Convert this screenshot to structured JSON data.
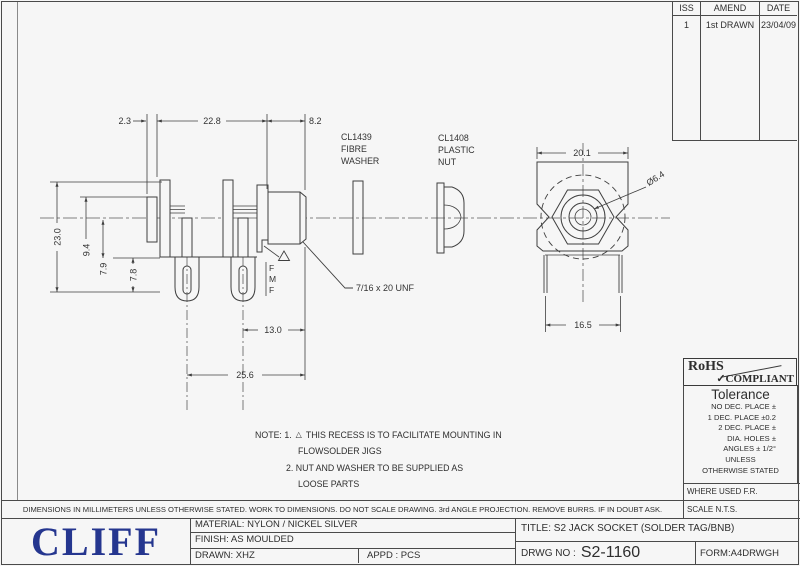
{
  "revision_table": {
    "headers": [
      "ISS",
      "AMEND",
      "DATE"
    ],
    "row": {
      "iss": "1",
      "amend": "1st DRAWN",
      "date": "23/04/09"
    }
  },
  "drawing": {
    "dim_top_left": "2.3",
    "dim_top_mid": "22.8",
    "dim_top_right": "8.2",
    "dim_height": "23.0",
    "dim_left_a": "9.4",
    "dim_left_b": "7.9",
    "dim_left_c": "7.8",
    "dim_bot_a": "13.0",
    "dim_bot_b": "25.6",
    "dim_face_width": "20.1",
    "dim_hole": "Ø6.4",
    "dim_leg_span": "16.5",
    "thread_label": "7/16 x 20 UNF",
    "washer_label": {
      "l1": "CL1439",
      "l2": "FIBRE",
      "l3": "WASHER"
    },
    "nut_label": {
      "l1": "CL1408",
      "l2": "PLASTIC",
      "l3": "NUT"
    },
    "markings": {
      "m1": "F",
      "m2": "M",
      "m3": "F"
    }
  },
  "notes": {
    "label": "NOTE:  1.",
    "triangle": "△",
    "n1a": "THIS RECESS IS TO FACILITATE MOUNTING IN",
    "n1b": "FLOWSOLDER JIGS",
    "n2a": "2. NUT AND WASHER TO BE SUPPLIED AS",
    "n2b": "LOOSE PARTS"
  },
  "rohs": {
    "l1": "RoHS",
    "l2": "✓COMPLIANT"
  },
  "tolerance": {
    "heading": "Tolerance",
    "lines": [
      "NO DEC. PLACE ±",
      "1 DEC. PLACE ±0.2",
      "2 DEC. PLACE ±",
      "DIA. HOLES ±",
      "ANGLES ± 1/2°",
      "UNLESS",
      "OTHERWISE STATED"
    ]
  },
  "footer": {
    "disclaimer": "DIMENSIONS IN MILLIMETERS UNLESS OTHERWISE STATED. WORK TO DIMENSIONS. DO NOT SCALE DRAWING. 3rd ANGLE PROJECTION. REMOVE BURRS. IF IN DOUBT ASK.",
    "where_used": "WHERE USED F.R.",
    "scale": "SCALE N.T.S."
  },
  "title_block": {
    "logo": "CLIFF",
    "material": "MATERIAL: NYLON / NICKEL SILVER",
    "finish": "FINISH: AS MOULDED",
    "drawn": "DRAWN: XHZ",
    "appd": "APPD :   PCS",
    "title": "TITLE: S2 JACK SOCKET (SOLDER TAG/BNB)",
    "drwg_label": "DRWG  NO :",
    "drwg_no": "S2-1160",
    "form": "FORM:A4DRWGH"
  },
  "colors": {
    "logo_blue": "#25368f",
    "line": "#3f3f3f"
  }
}
